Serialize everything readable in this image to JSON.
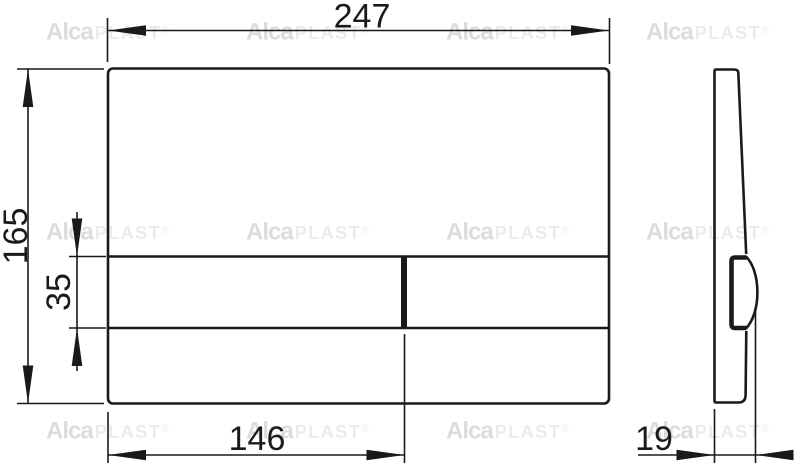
{
  "drawing_type": "technical-dimension-drawing",
  "dimensions": {
    "front": {
      "width": "247",
      "height": "165",
      "button_band_height": "35",
      "button_width": "146"
    },
    "side": {
      "depth": "19"
    }
  },
  "watermark": {
    "brand_bold": "Alca",
    "brand_light": "PLAST",
    "registered": "®",
    "tile_centers": [
      [
        98,
        31
      ],
      [
        298,
        31
      ],
      [
        498,
        31
      ],
      [
        698,
        31
      ],
      [
        98,
        231
      ],
      [
        298,
        231
      ],
      [
        498,
        231
      ],
      [
        698,
        231
      ],
      [
        98,
        430
      ],
      [
        298,
        430
      ],
      [
        498,
        430
      ],
      [
        698,
        430
      ]
    ]
  }
}
